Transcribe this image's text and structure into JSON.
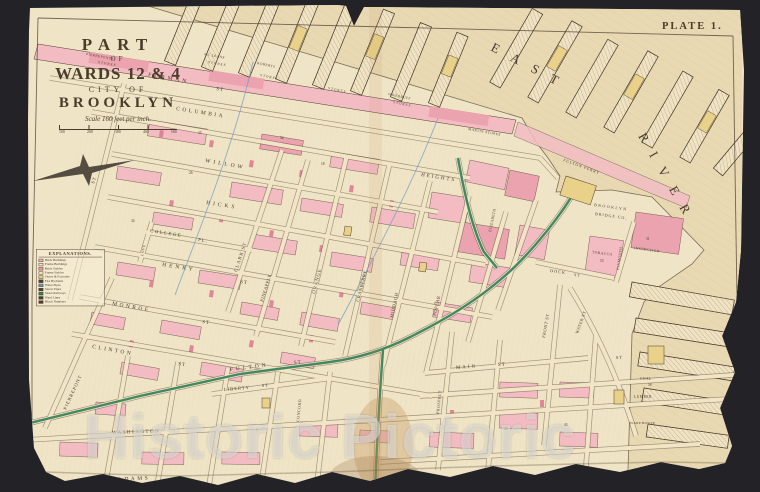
{
  "plate": {
    "label": "PLATE 1."
  },
  "title": {
    "part": "PART",
    "of": "OF",
    "wards": "WARDS 12 & 4",
    "city_of": "CITY OF",
    "brooklyn": "BROOKLYN",
    "scale_text": "Scale 160 feet per inch.",
    "scale_ticks": [
      "100",
      "200",
      "300",
      "400",
      "500"
    ]
  },
  "legend": {
    "title": "EXPLANATIONS.",
    "items": [
      "Brick Buildings",
      "Frame Buildings",
      "Brick Stables",
      "Frame Stables",
      "Stores & Factories",
      "Fire Hydrants",
      "Water Pipes",
      "Sewer Pipes",
      "Street Railways",
      "Ward Lines",
      "Block Numbers"
    ],
    "symbol_colors": [
      "#f3bcc3",
      "#f1e5c6",
      "#eba3af",
      "#f1e5c6",
      "#e9d189",
      "#4a3c2c",
      "#6d9bc4",
      "#4a3c2c",
      "#2f7e55",
      "#4a3c2c",
      "#4a3c2c"
    ]
  },
  "watermark": {
    "text": "Historic Pictoric"
  },
  "colors": {
    "dark_bg": "#232327",
    "paper": "#f0e4c6",
    "water": "#e8d9b3",
    "pink": "#f3bcc3",
    "pink_deep": "#eba3af",
    "red_small": "#df7b92",
    "yellow": "#e9d189",
    "green": "#2f7e55",
    "blue": "#6d9bc4",
    "ink": "#4a3c2c",
    "street_fill": "#f1e5c6"
  },
  "map_labels": [
    {
      "t": "EAST",
      "x": 490,
      "y": 50,
      "r": 28,
      "s": 13,
      "ls": 14,
      "n": "river-name-east"
    },
    {
      "t": "RIVER",
      "x": 638,
      "y": 136,
      "r": 60,
      "s": 13,
      "ls": 13,
      "n": "river-name-river"
    },
    {
      "t": "FURMAN",
      "x": 148,
      "y": 76,
      "r": 10,
      "s": 5.5,
      "ls": 3,
      "n": "street-furman"
    },
    {
      "t": "ST",
      "x": 216,
      "y": 90,
      "r": 10,
      "s": 5,
      "ls": 1,
      "n": "street-suffix"
    },
    {
      "t": "COLUMBIA",
      "x": 176,
      "y": 110,
      "r": 9,
      "s": 5.5,
      "ls": 2.5,
      "n": "street-columbia"
    },
    {
      "t": "HEIGHTS",
      "x": 421,
      "y": 176,
      "r": 9,
      "s": 5,
      "ls": 2,
      "n": "street-columbia-heights"
    },
    {
      "t": "WILLOW",
      "x": 205,
      "y": 162,
      "r": 10,
      "s": 5.5,
      "ls": 3,
      "n": "street-willow"
    },
    {
      "t": "HICKS",
      "x": 206,
      "y": 204,
      "r": 9,
      "s": 5.5,
      "ls": 3,
      "n": "street-hicks"
    },
    {
      "t": "COLLEGE",
      "x": 150,
      "y": 232,
      "r": 9,
      "s": 4.8,
      "ls": 1.5,
      "n": "street-college-place"
    },
    {
      "t": "PL.",
      "x": 198,
      "y": 241,
      "r": 9,
      "s": 4.8,
      "ls": 1,
      "n": "street-suffix"
    },
    {
      "t": "HENRY",
      "x": 162,
      "y": 266,
      "r": 9,
      "s": 5.5,
      "ls": 3,
      "n": "street-henry"
    },
    {
      "t": "ST",
      "x": 240,
      "y": 283,
      "r": 9,
      "s": 5,
      "ls": 1,
      "n": "street-suffix"
    },
    {
      "t": "MONROE",
      "x": 112,
      "y": 305,
      "r": 10,
      "s": 5.5,
      "ls": 2.5,
      "n": "street-monroe"
    },
    {
      "t": "ST",
      "x": 202,
      "y": 323,
      "r": 10,
      "s": 5,
      "ls": 1,
      "n": "street-suffix"
    },
    {
      "t": "CLINTON",
      "x": 92,
      "y": 348,
      "r": 10,
      "s": 5.5,
      "ls": 2.5,
      "n": "street-clinton"
    },
    {
      "t": "ST",
      "x": 178,
      "y": 365,
      "r": 10,
      "s": 5,
      "ls": 1,
      "n": "street-suffix"
    },
    {
      "t": "PIERREPONT",
      "x": 66,
      "y": 410,
      "r": -65,
      "s": 4.6,
      "ls": 1,
      "n": "street-pierrepont"
    },
    {
      "t": "LOVE",
      "x": 143,
      "y": 256,
      "r": -78,
      "s": 3.6,
      "ls": 0.5,
      "n": "street-love-lane"
    },
    {
      "t": "CLARK ST",
      "x": 237,
      "y": 272,
      "r": -72,
      "s": 4.8,
      "ls": 1,
      "n": "street-clark"
    },
    {
      "t": "PINEAPPLE",
      "x": 263,
      "y": 302,
      "r": -73,
      "s": 4.6,
      "ls": 0.5,
      "n": "street-pineapple"
    },
    {
      "t": "ORANGE",
      "x": 315,
      "y": 294,
      "r": -76,
      "s": 4.8,
      "ls": 1,
      "n": "street-orange"
    },
    {
      "t": "CRANBERRY",
      "x": 359,
      "y": 302,
      "r": -76,
      "s": 4.6,
      "ls": 0.5,
      "n": "street-cranberry"
    },
    {
      "t": "MIDDAGH",
      "x": 393,
      "y": 318,
      "r": -78,
      "s": 4.6,
      "ls": 0.5,
      "n": "street-middagh"
    },
    {
      "t": "POPLAR",
      "x": 436,
      "y": 316,
      "r": -78,
      "s": 4.6,
      "ls": 0.5,
      "n": "street-poplar"
    },
    {
      "t": "ELIZABETH",
      "x": 491,
      "y": 232,
      "r": -78,
      "s": 3.8,
      "ls": 0.3,
      "n": "street-elizabeth"
    },
    {
      "t": "FULTON",
      "x": 230,
      "y": 371,
      "r": -7,
      "s": 5.5,
      "ls": 3,
      "n": "street-fulton"
    },
    {
      "t": "ST",
      "x": 294,
      "y": 364,
      "r": -5,
      "s": 5,
      "ls": 1,
      "n": "street-suffix"
    },
    {
      "t": "MAIN",
      "x": 456,
      "y": 369,
      "r": -4,
      "s": 5,
      "ls": 2,
      "n": "street-main"
    },
    {
      "t": "ST",
      "x": 498,
      "y": 366,
      "r": -4,
      "s": 5,
      "ls": 1,
      "n": "street-suffix"
    },
    {
      "t": "FRONT ST",
      "x": 545,
      "y": 338,
      "r": -80,
      "s": 4.4,
      "ls": 0.5,
      "n": "street-front"
    },
    {
      "t": "PROSPECT",
      "x": 439,
      "y": 414,
      "r": -84,
      "s": 4,
      "ls": 0.5,
      "n": "street-prospect"
    },
    {
      "t": "WASHINGTON",
      "x": 112,
      "y": 434,
      "r": -2,
      "s": 5,
      "ls": 1.5,
      "n": "street-washington"
    },
    {
      "t": "ADAMS",
      "x": 118,
      "y": 481,
      "r": -3,
      "s": 5.5,
      "ls": 2.5,
      "n": "street-adams"
    },
    {
      "t": "MYRTLE",
      "x": 24,
      "y": 472,
      "r": -80,
      "s": 4,
      "ls": 0.5,
      "n": "street-myrtle"
    },
    {
      "t": "LIBERTY",
      "x": 224,
      "y": 391,
      "r": -5,
      "s": 4.6,
      "ls": 1,
      "n": "street-liberty"
    },
    {
      "t": "ST",
      "x": 262,
      "y": 387,
      "r": -5,
      "s": 4.4,
      "ls": 1,
      "n": "street-suffix"
    },
    {
      "t": "CONCORD",
      "x": 299,
      "y": 422,
      "r": -84,
      "s": 4,
      "ls": 0.5,
      "n": "street-concord"
    },
    {
      "t": "DOCK",
      "x": 550,
      "y": 272,
      "r": 7,
      "s": 4.2,
      "ls": 1,
      "n": "street-dock"
    },
    {
      "t": "ST",
      "x": 574,
      "y": 276,
      "r": 7,
      "s": 4,
      "ls": 1,
      "n": "street-suffix"
    },
    {
      "t": "WATER ST",
      "x": 578,
      "y": 334,
      "r": -70,
      "s": 4.2,
      "ls": 0.5,
      "n": "street-water"
    },
    {
      "t": "PLYMOUTH",
      "x": 619,
      "y": 270,
      "r": -82,
      "s": 3.8,
      "ls": 0.3,
      "n": "street-plymouth"
    },
    {
      "t": "ST",
      "x": 94,
      "y": 184,
      "r": -72,
      "s": 4.6,
      "ls": 1,
      "n": "street-suffix"
    },
    {
      "t": "ST",
      "x": 616,
      "y": 359,
      "r": -3,
      "s": 4.4,
      "ls": 1,
      "n": "street-suffix"
    },
    {
      "t": "BROOKLYN",
      "x": 594,
      "y": 206,
      "r": 8,
      "s": 4,
      "ls": 1.5,
      "n": "label-brooklyn-bridge-co"
    },
    {
      "t": "BRIDGE CO.",
      "x": 595,
      "y": 215,
      "r": 8,
      "s": 4,
      "ls": 1,
      "n": "label-brooklyn-bridge-co"
    },
    {
      "t": "TOBACCO",
      "x": 592,
      "y": 253,
      "r": 8,
      "s": 3.6,
      "ls": 0.5,
      "n": "label-tobacco"
    },
    {
      "t": "INSPECTION",
      "x": 634,
      "y": 249,
      "r": 8,
      "s": 3.6,
      "ls": 0.5,
      "n": "label-inspection"
    },
    {
      "t": "FULTON FERRY",
      "x": 563,
      "y": 161,
      "r": 20,
      "s": 4,
      "ls": 0.8,
      "n": "label-fulton-ferry"
    },
    {
      "t": "PIERREPONTS",
      "x": 86,
      "y": 55,
      "r": 10,
      "s": 3.4,
      "ls": 0.5,
      "n": "label-pierreponts-stores"
    },
    {
      "t": "STORES",
      "x": 98,
      "y": 63,
      "r": 10,
      "s": 3.4,
      "ls": 1,
      "n": "label-pierreponts-stores"
    },
    {
      "t": "MC LEANS",
      "x": 204,
      "y": 55,
      "r": 10,
      "s": 3.4,
      "ls": 0.5,
      "n": "label-mcleans-stores"
    },
    {
      "t": "STORES",
      "x": 208,
      "y": 63,
      "r": 10,
      "s": 3.4,
      "ls": 1,
      "n": "label-mcleans-stores"
    },
    {
      "t": "ROBERTS",
      "x": 257,
      "y": 64,
      "r": 12,
      "s": 3.4,
      "ls": 0.5,
      "n": "label-roberts-stores"
    },
    {
      "t": "STORES",
      "x": 260,
      "y": 76,
      "r": 12,
      "s": 3.4,
      "ls": 1,
      "n": "label-roberts-stores"
    },
    {
      "t": "STORES",
      "x": 328,
      "y": 89,
      "r": 12,
      "s": 3.4,
      "ls": 1,
      "n": "label-stores"
    },
    {
      "t": "WOODRUFF",
      "x": 388,
      "y": 95,
      "r": 12,
      "s": 3.4,
      "ls": 0.5,
      "n": "label-woodruff-stores"
    },
    {
      "t": "STORES",
      "x": 393,
      "y": 103,
      "r": 12,
      "s": 3.4,
      "ls": 1,
      "n": "label-woodruff-stores"
    },
    {
      "t": "MARTIN STORES",
      "x": 468,
      "y": 130,
      "r": 10,
      "s": 3.4,
      "ls": 0.5,
      "n": "label-martin-stores"
    },
    {
      "t": "WAREHOUSE",
      "x": 630,
      "y": 424,
      "r": 0,
      "s": 3.4,
      "ls": 0.5,
      "n": "label-warehouse"
    },
    {
      "t": "COAL",
      "x": 640,
      "y": 380,
      "r": 0,
      "s": 3.6,
      "ls": 0.5,
      "n": "label-coal"
    },
    {
      "t": "LUMBER",
      "x": 634,
      "y": 398,
      "r": 0,
      "s": 3.6,
      "ls": 0.5,
      "n": "label-lumber"
    },
    {
      "t": "25",
      "x": 198,
      "y": 134,
      "r": 0,
      "s": 3.6,
      "ls": 0,
      "n": "block-number"
    },
    {
      "t": "26",
      "x": 189,
      "y": 174,
      "r": 0,
      "s": 3.6,
      "ls": 0,
      "n": "block-number"
    },
    {
      "t": "52",
      "x": 280,
      "y": 139,
      "r": 0,
      "s": 3.6,
      "ls": 0,
      "n": "block-number"
    },
    {
      "t": "18",
      "x": 321,
      "y": 165,
      "r": 0,
      "s": 3.6,
      "ls": 0,
      "n": "block-number"
    },
    {
      "t": "34",
      "x": 131,
      "y": 222,
      "r": 0,
      "s": 3.6,
      "ls": 0,
      "n": "block-number"
    },
    {
      "t": "31",
      "x": 646,
      "y": 240,
      "r": 0,
      "s": 3.6,
      "ls": 0,
      "n": "block-number"
    },
    {
      "t": "53",
      "x": 600,
      "y": 262,
      "r": 0,
      "s": 3.6,
      "ls": 0,
      "n": "block-number"
    },
    {
      "t": "58",
      "x": 648,
      "y": 386,
      "r": 0,
      "s": 3.6,
      "ls": 0,
      "n": "block-number"
    },
    {
      "t": "45",
      "x": 504,
      "y": 430,
      "r": 0,
      "s": 3.6,
      "ls": 0,
      "n": "block-number"
    },
    {
      "t": "43",
      "x": 564,
      "y": 426,
      "r": 0,
      "s": 3.6,
      "ls": 0,
      "n": "block-number"
    }
  ]
}
